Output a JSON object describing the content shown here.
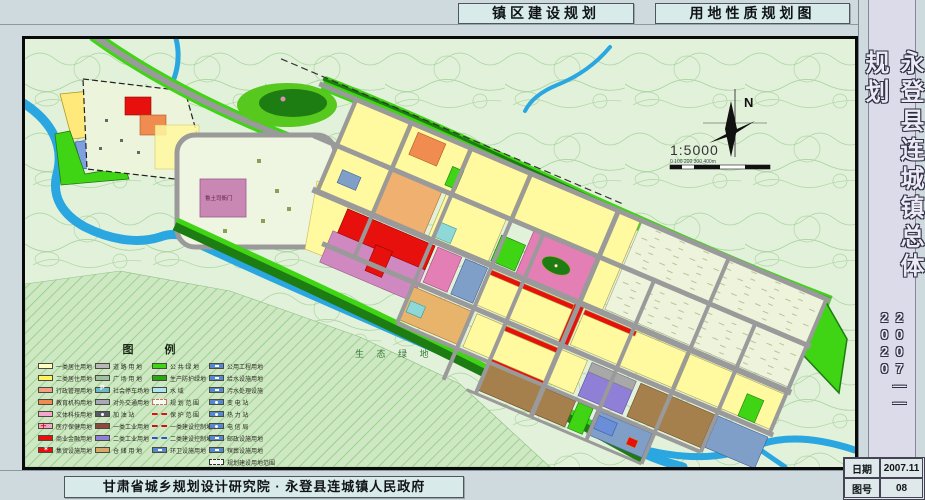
{
  "header": {
    "title_left": "镇区建设规划",
    "title_right": "用地性质规划图"
  },
  "titleblock": {
    "project": "永登县连城镇总体规划",
    "period": "2007——2020",
    "date_label": "日期",
    "date_value": "2007.11",
    "sheet_label": "图号",
    "sheet_value": "08"
  },
  "footer": {
    "credit": "甘肃省城乡规划设计研究院 · 永登县连城镇人民政府"
  },
  "map": {
    "north_label": "N",
    "scale_text": "1:5000",
    "scalebar_text": "0  100  200  300  400m",
    "labels": {
      "heritage_site": "鲁土司衙门",
      "eco_green": "生 态 绿 地"
    },
    "colors": {
      "river": "#2aa7e0",
      "bright_green": "#3fd414",
      "dark_green": "#1d7c12",
      "residential_yellow": "#fff9a0",
      "commercial_red": "#e8100c",
      "culture_pink": "#e37fb4",
      "heritage_pink": "#c987b4",
      "education_orange": "#f08c50",
      "storage_brown": "#a5804d",
      "industry_purple": "#8f7fd6",
      "utility_blue": "#5588cc",
      "road_gray": "#9a9a9a",
      "water_cyan": "#8fd8d8",
      "contour_green": "#a6d49c"
    }
  },
  "legend": {
    "title": "图  例",
    "columns": [
      {
        "items": [
          {
            "label": "一类居住用地",
            "color": "#fffdc2"
          },
          {
            "label": "二类居住用地",
            "color": "#fff45e"
          },
          {
            "label": "行政管理用地",
            "color": "#f0a080"
          },
          {
            "label": "教育机构用地",
            "color": "#f08c50"
          },
          {
            "label": "文体科技用地",
            "color": "#f2a6c8"
          },
          {
            "label": "医疗保健用地",
            "color": "#f2a6c8"
          },
          {
            "label": "商业金融用地",
            "color": "#e8100c"
          },
          {
            "label": "集贸设施用地",
            "color": "#e8100c"
          }
        ]
      },
      {
        "items": [
          {
            "label": "道 路 用 地",
            "color": "#b8b8b8"
          },
          {
            "label": "广 场 用 地",
            "color": "#9fbf9f"
          },
          {
            "label": "社会停车场地",
            "color": "#6fb8c8"
          },
          {
            "label": "对外交通用地",
            "color": "#a8a8b8"
          },
          {
            "label": "加 油 站",
            "color": "#5a5a66"
          },
          {
            "label": "一类工业用地",
            "color": "#8c4a3c"
          },
          {
            "label": "二类工业用地",
            "color": "#8f7fd6"
          },
          {
            "label": "仓 储 用 地",
            "color": "#d8a868"
          }
        ]
      },
      {
        "items": [
          {
            "label": "公 共 绿 地",
            "color": "#3fd414"
          },
          {
            "label": "生产防护绿地",
            "color": "#2aa812"
          },
          {
            "label": "水    域",
            "color": "#aee4f4"
          },
          {
            "label": "规 划 范 围",
            "color": "#f6fbf2"
          },
          {
            "label": "保 护 范 围",
            "color": "#e01010"
          },
          {
            "label": "一类建设控制地带",
            "color": "#cc1010"
          },
          {
            "label": "二类建设控制地带",
            "color": "#2255cc"
          },
          {
            "label": "环卫设施用地",
            "color": "#5588cc"
          }
        ]
      },
      {
        "items": [
          {
            "label": "公用工程用地",
            "color": "#5588cc"
          },
          {
            "label": "给水设施用地",
            "color": "#5588cc"
          },
          {
            "label": "污水处理设施",
            "color": "#5588cc"
          },
          {
            "label": "变  电  站",
            "color": "#5588cc"
          },
          {
            "label": "热  力  站",
            "color": "#5588cc"
          },
          {
            "label": "电  信  局",
            "color": "#5588cc"
          },
          {
            "label": "邮政设施用地",
            "color": "#5588cc"
          },
          {
            "label": "殡葬设施用地",
            "color": "#5588cc"
          },
          {
            "label": "规划建设用地范围",
            "color": "#f6fbf2"
          }
        ]
      }
    ]
  }
}
